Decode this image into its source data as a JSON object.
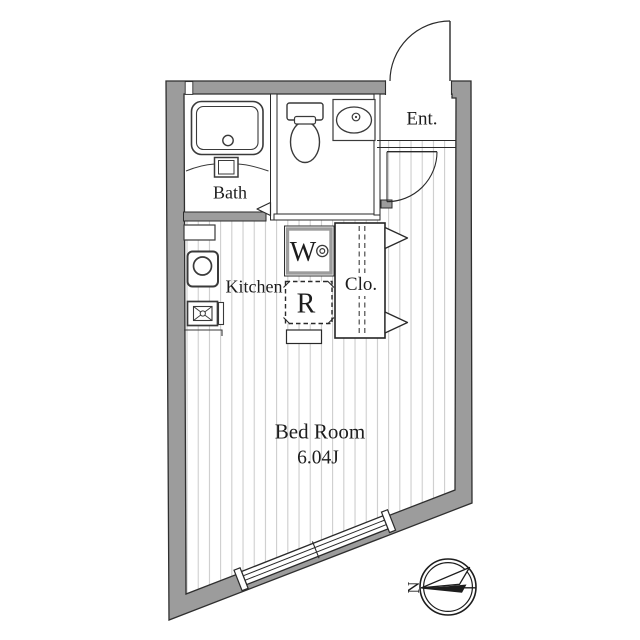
{
  "meta": {
    "type": "apartment-floor-plan"
  },
  "colors": {
    "wall": "#9c9c9c",
    "wall_outline": "#2f2f2f",
    "floor_stripe": "#cbcbcb",
    "ink": "#2a2a2a",
    "text": "#1d1d1d"
  },
  "rooms": {
    "bath": {
      "label": "Bath"
    },
    "kitchen": {
      "label": "Kitchen"
    },
    "entrance": {
      "label": "Ent."
    },
    "closet": {
      "label": "Clo."
    },
    "bedroom": {
      "label": "Bed Room",
      "area": "6.04J"
    }
  },
  "appliances": {
    "washing_machine": {
      "label": "W"
    },
    "refrigerator": {
      "label": "R"
    }
  },
  "compass": {
    "north_label": "N"
  }
}
